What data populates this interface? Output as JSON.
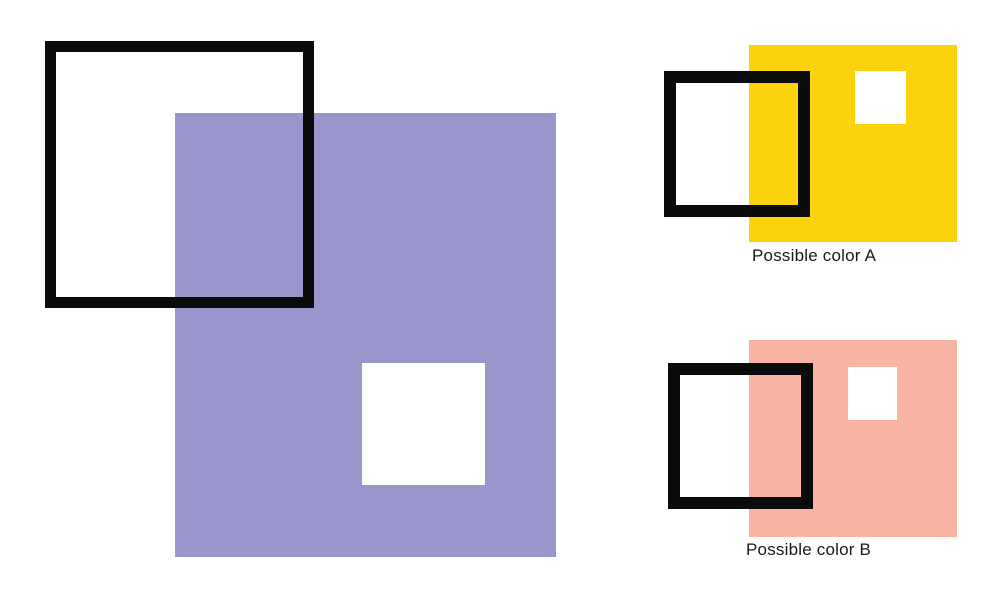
{
  "page": {
    "background": "#FFFFFF"
  },
  "colors": {
    "target_purple": "#9A96CB",
    "option_a_yellow": "#FBD20C",
    "option_b_salmon": "#F8B5A3",
    "outline_black": "#0B0B0B",
    "cutout_white": "#FFFFFF",
    "label_text": "#1A1A1A"
  },
  "target": {
    "shapes": {
      "large_color_square": "purple filled square",
      "white_cutout_square": "small white square inside purple square",
      "black_outline_square": "black open square overlapping top-left corner"
    }
  },
  "options": [
    {
      "id": "A",
      "label": "Possible color A",
      "color": "#FBD20C"
    },
    {
      "id": "B",
      "label": "Possible color B",
      "color": "#F8B5A3"
    }
  ]
}
